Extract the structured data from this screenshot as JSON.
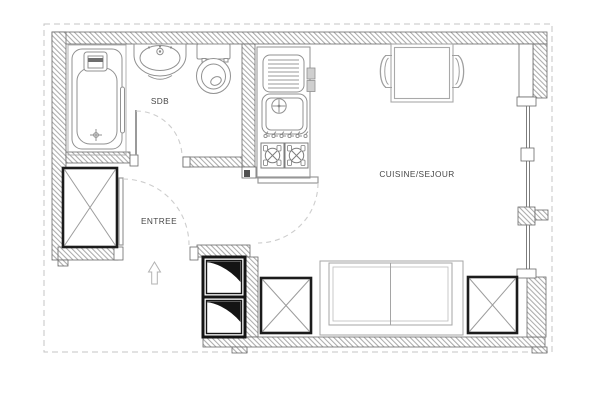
{
  "plan": {
    "rooms": [
      {
        "id": "sdb",
        "label": "SDB"
      },
      {
        "id": "entree",
        "label": "ENTREE"
      },
      {
        "id": "cuisine_sejour",
        "label": "CUISINE/SEJOUR"
      }
    ],
    "symbols": [
      "bathtub",
      "washbasin",
      "toilet",
      "kitchen-sink-unit",
      "gas-stove",
      "dining-table",
      "chairs",
      "wardrobe-x-box",
      "duct-shaft-squares",
      "sofa",
      "x-storage-squares",
      "door-swing-arcs",
      "entrance-arrow",
      "window-glazing",
      "hatched-walls",
      "dashed-property-boundary"
    ],
    "colors": {
      "background": "#ffffff",
      "wall_outline": "#6a6a6a",
      "wall_hatch": "#a6a6a6",
      "fixture_line": "#8f8f8f",
      "furniture_dark": "#1c1c1c",
      "door_swing_dash": "#cdcdcd",
      "boundary_dash": "#c4c4c4",
      "label_text": "#474747"
    }
  }
}
